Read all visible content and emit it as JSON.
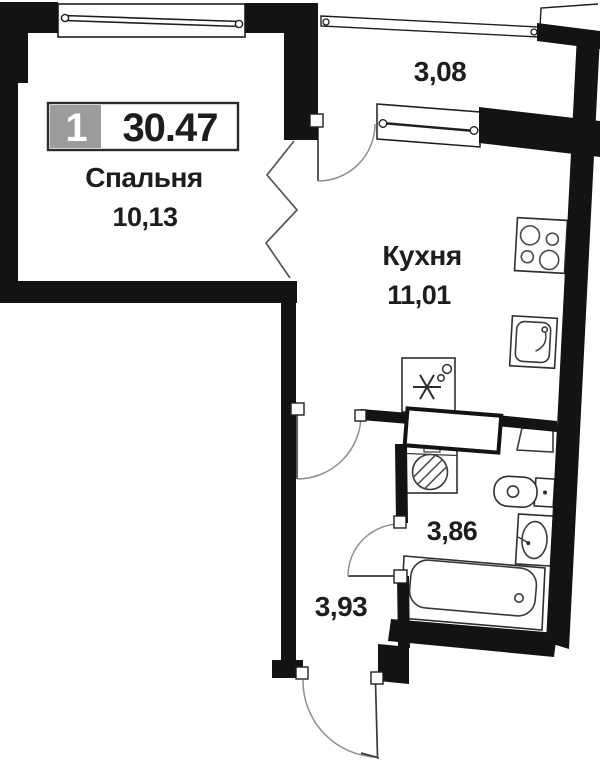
{
  "plan": {
    "badge": {
      "rooms": "1",
      "total_area": "30.47"
    },
    "rooms": {
      "bedroom": {
        "name": "Спальня",
        "area": "10,13"
      },
      "kitchen": {
        "name": "Кухня",
        "area": "11,01"
      },
      "balcony": {
        "area": "3,08"
      },
      "bathroom": {
        "area": "3,86"
      },
      "hallway": {
        "area": "3,93"
      }
    },
    "colors": {
      "wall": "#131313",
      "door_arc": "#8f8f8f",
      "fixture_line": "#2e2e2e",
      "badge_gray": "#9c9c9c",
      "text": "#1d1d1d",
      "background": "#ffffff"
    },
    "icons": {
      "kitchen": [
        "stove-icon",
        "kitchen-sink-icon",
        "fridge-icon"
      ],
      "bathroom": [
        "washing-machine-icon",
        "toilet-icon",
        "bathroom-sink-icon",
        "bathtub-icon",
        "cabinet-icon"
      ],
      "symbols": [
        "window-symbol",
        "door-swing-symbol",
        "wall-break-zigzag-symbol",
        "sliding-door-symbol"
      ]
    }
  }
}
